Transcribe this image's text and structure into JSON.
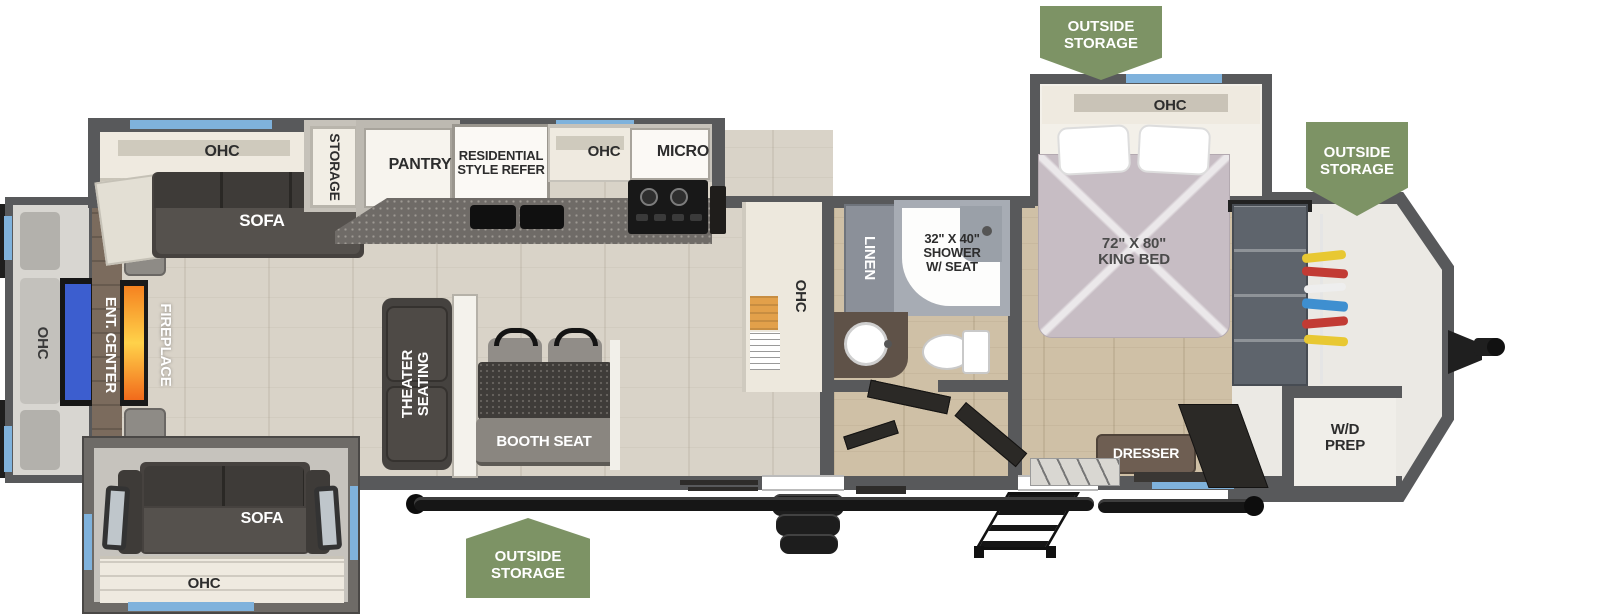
{
  "title": "Travel trailer floorplan",
  "badges": {
    "top": "OUTSIDE\nSTORAGE",
    "front": "OUTSIDE\nSTORAGE",
    "bottom": "OUTSIDE\nSTORAGE"
  },
  "rear_entertainment": {
    "ohc_label": "OHC",
    "ent_center_label": "ENT. CENTER",
    "fireplace_label": "FIREPLACE"
  },
  "living_area": {
    "ohc_label": "OHC",
    "sofa_label": "SOFA",
    "storage_label": "STORAGE",
    "theater_seating_label": "THEATER\nSEATING",
    "booth_seat_label": "BOOTH SEAT"
  },
  "kitchen": {
    "pantry_label": "PANTRY",
    "refrigerator_label": "RESIDENTIAL\nSTYLE REFER",
    "ohc_label": "OHC",
    "micro_label": "MICRO",
    "hutch_ohc_label": "OHC"
  },
  "bathroom": {
    "linen_label": "LINEN",
    "shower_label": "32\" X 40\"\nSHOWER\nW/ SEAT"
  },
  "bedroom": {
    "ohc_label": "OHC",
    "king_bed_label": "72\" X 80\"\nKING BED",
    "dresser_label": "DRESSER"
  },
  "front_area": {
    "wd_prep_label": "W/D\nPREP"
  },
  "bottom_slide": {
    "sofa_label": "SOFA",
    "ohc_label": "OHC"
  },
  "colors": {
    "wall": "#58595B",
    "window_blue": "#7FB2DC",
    "badge_green": "#7D9365",
    "floor_living": "#D9D3C8",
    "floor_bed": "#CFC0A6",
    "floor_front": "#EBE9E4",
    "counter_dark": "#6F6B67",
    "furniture_dark": "#46423F",
    "cabinet_cream": "#EFEAE0",
    "bed_mauve": "#C7BDC4",
    "fireplace_orange": "#F58220",
    "tv_blue": "#3C5ECF",
    "door_black": "#2B2926",
    "wood_console": "#7B6B5D",
    "linen_gray": "#8B9099",
    "wardrobe_gray": "#5E646C",
    "dresser_brown": "#6E5E52",
    "slide_gray": "#C6C3BD"
  }
}
